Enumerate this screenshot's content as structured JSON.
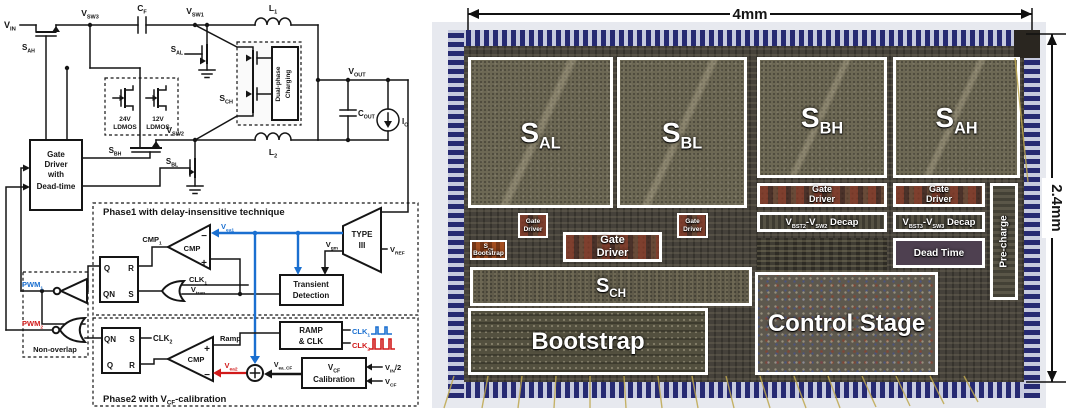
{
  "colors": {
    "phase1_blue": "#1a6fd0",
    "phase2_red": "#d11a1a",
    "pad_blue": "#262a72",
    "die_olive": "#6d6854",
    "gate_driver_red": "#7a3b2c",
    "bootstrap_orange": "#a34e20"
  },
  "schematic": {
    "vin": "V~IN~",
    "sah": "S~AH~",
    "vsw3": "V~SW3~",
    "cf": "C~F~",
    "vsw1": "V~SW1~",
    "l1": "L~1~",
    "sal": "S~AL~",
    "ldmos24_v": "24V",
    "ldmos24_t": "LDMOS",
    "ldmos12_v": "12V",
    "ldmos12_t": "LDMOS",
    "sch": "S~CH~",
    "dual1": "Dual-phase",
    "dual2": "Charging",
    "vout": "V~OUT~",
    "cout": "C~OUT~",
    "io": "I~O~",
    "sbh": "S~BH~",
    "sbl": "S~BL~",
    "vsw2": "V~SW2~",
    "l2": "L~2~",
    "gd1": "Gate",
    "gd2": "Driver",
    "gd3": "with",
    "gd4": "Dead-time",
    "p1_title": "Phase1 with delay-insensitive technique",
    "p2_title": "Phase2 with V~CF~-calibration",
    "cmp1": "CMP~1~",
    "cmp": "CMP",
    "minus": "−",
    "plus": "+",
    "vea1": "V~ea1~",
    "vea2": "V~ea2~",
    "vea_cf": "V~ea_CF~",
    "type1": "TYPE",
    "type2": "III",
    "vref": "V~REF~",
    "vgm": "V~gm~",
    "td1": "Transient",
    "td2": "Detection",
    "clk1": "CLK~1~",
    "clk2": "CLK~2~",
    "vtran": "V~tran~",
    "q": "Q",
    "r": "R",
    "qn": "QN",
    "s": "S",
    "pwm1": "PWM~1~",
    "pwm2": "PWM~2~",
    "nonoverlap": "Non-overlap",
    "ramp": "Ramp",
    "rampclk1": "RAMP",
    "rampclk2": "& CLK",
    "vcf1": "V~CF~",
    "vcf2": "Calibration",
    "vin2": "V~IN~/2",
    "vcf": "V~CF~"
  },
  "die": {
    "dim_w": "4mm",
    "dim_h": "2.4mm",
    "sal": "S~AL~",
    "sbl": "S~BL~",
    "sbh": "S~BH~",
    "sah": "S~AH~",
    "gate": "Gate",
    "driver": "Driver",
    "decap2": "V~BST2~-V~SW2~ Decap",
    "decap3": "V~BST3~-V~SW3~ Decap",
    "dead_time": "Dead Time",
    "precharge": "Pre-charge",
    "schboot1": "S~CH~",
    "schboot2": "Bootstrap",
    "sch": "S~CH~",
    "bootstrap": "Bootstrap",
    "control": "Control Stage"
  }
}
